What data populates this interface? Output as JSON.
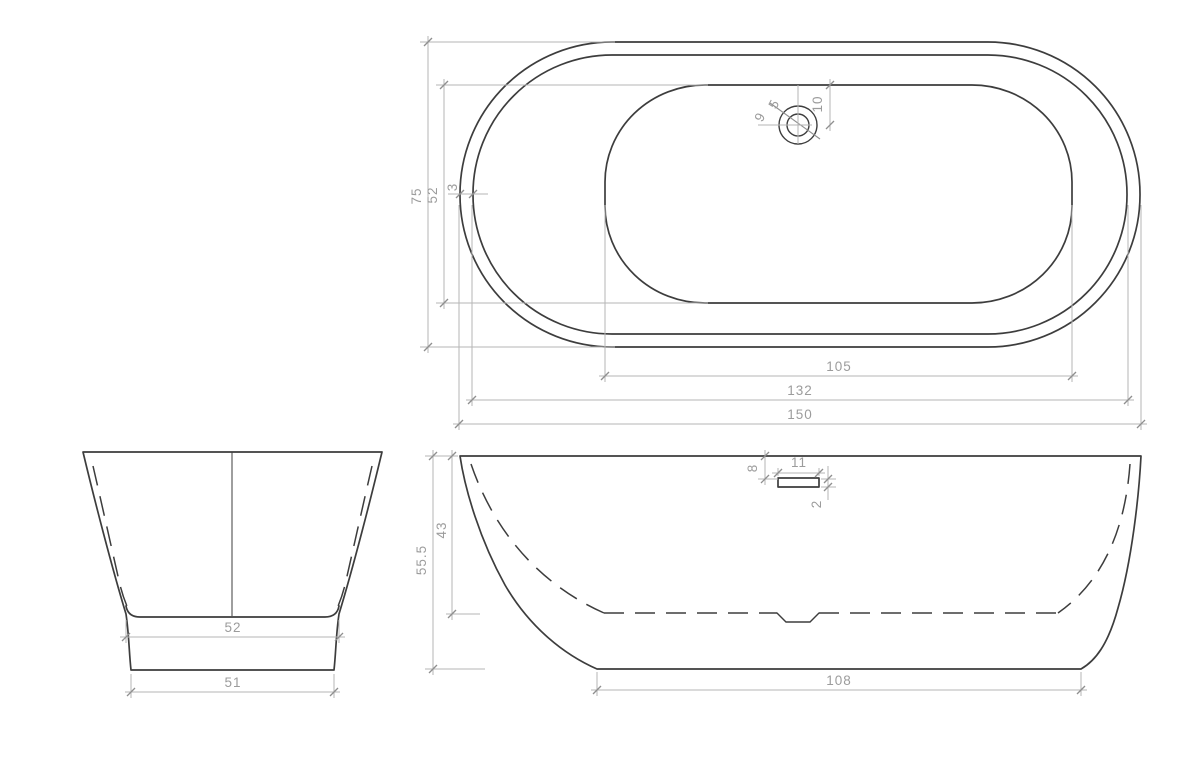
{
  "colors": {
    "background": "#ffffff",
    "outline": "#3d3d3d",
    "dimension_line": "#b6b6b6",
    "dimension_text": "#9c9c9c"
  },
  "top_view": {
    "overall_length": "150",
    "rim_length": "132",
    "bowl_length": "105",
    "overall_width": "75",
    "bowl_width": "52",
    "rim_thickness": "3",
    "drain_outer_diameter": "9",
    "drain_inner_diameter": "5",
    "drain_center_offset": "10"
  },
  "front_view": {
    "inner_bottom_width": "52",
    "base_width": "51"
  },
  "side_view": {
    "overall_height": "55.5",
    "inner_depth": "43",
    "base_length": "108",
    "overflow_top_offset": "8",
    "overflow_width": "11",
    "overflow_thickness": "2"
  }
}
